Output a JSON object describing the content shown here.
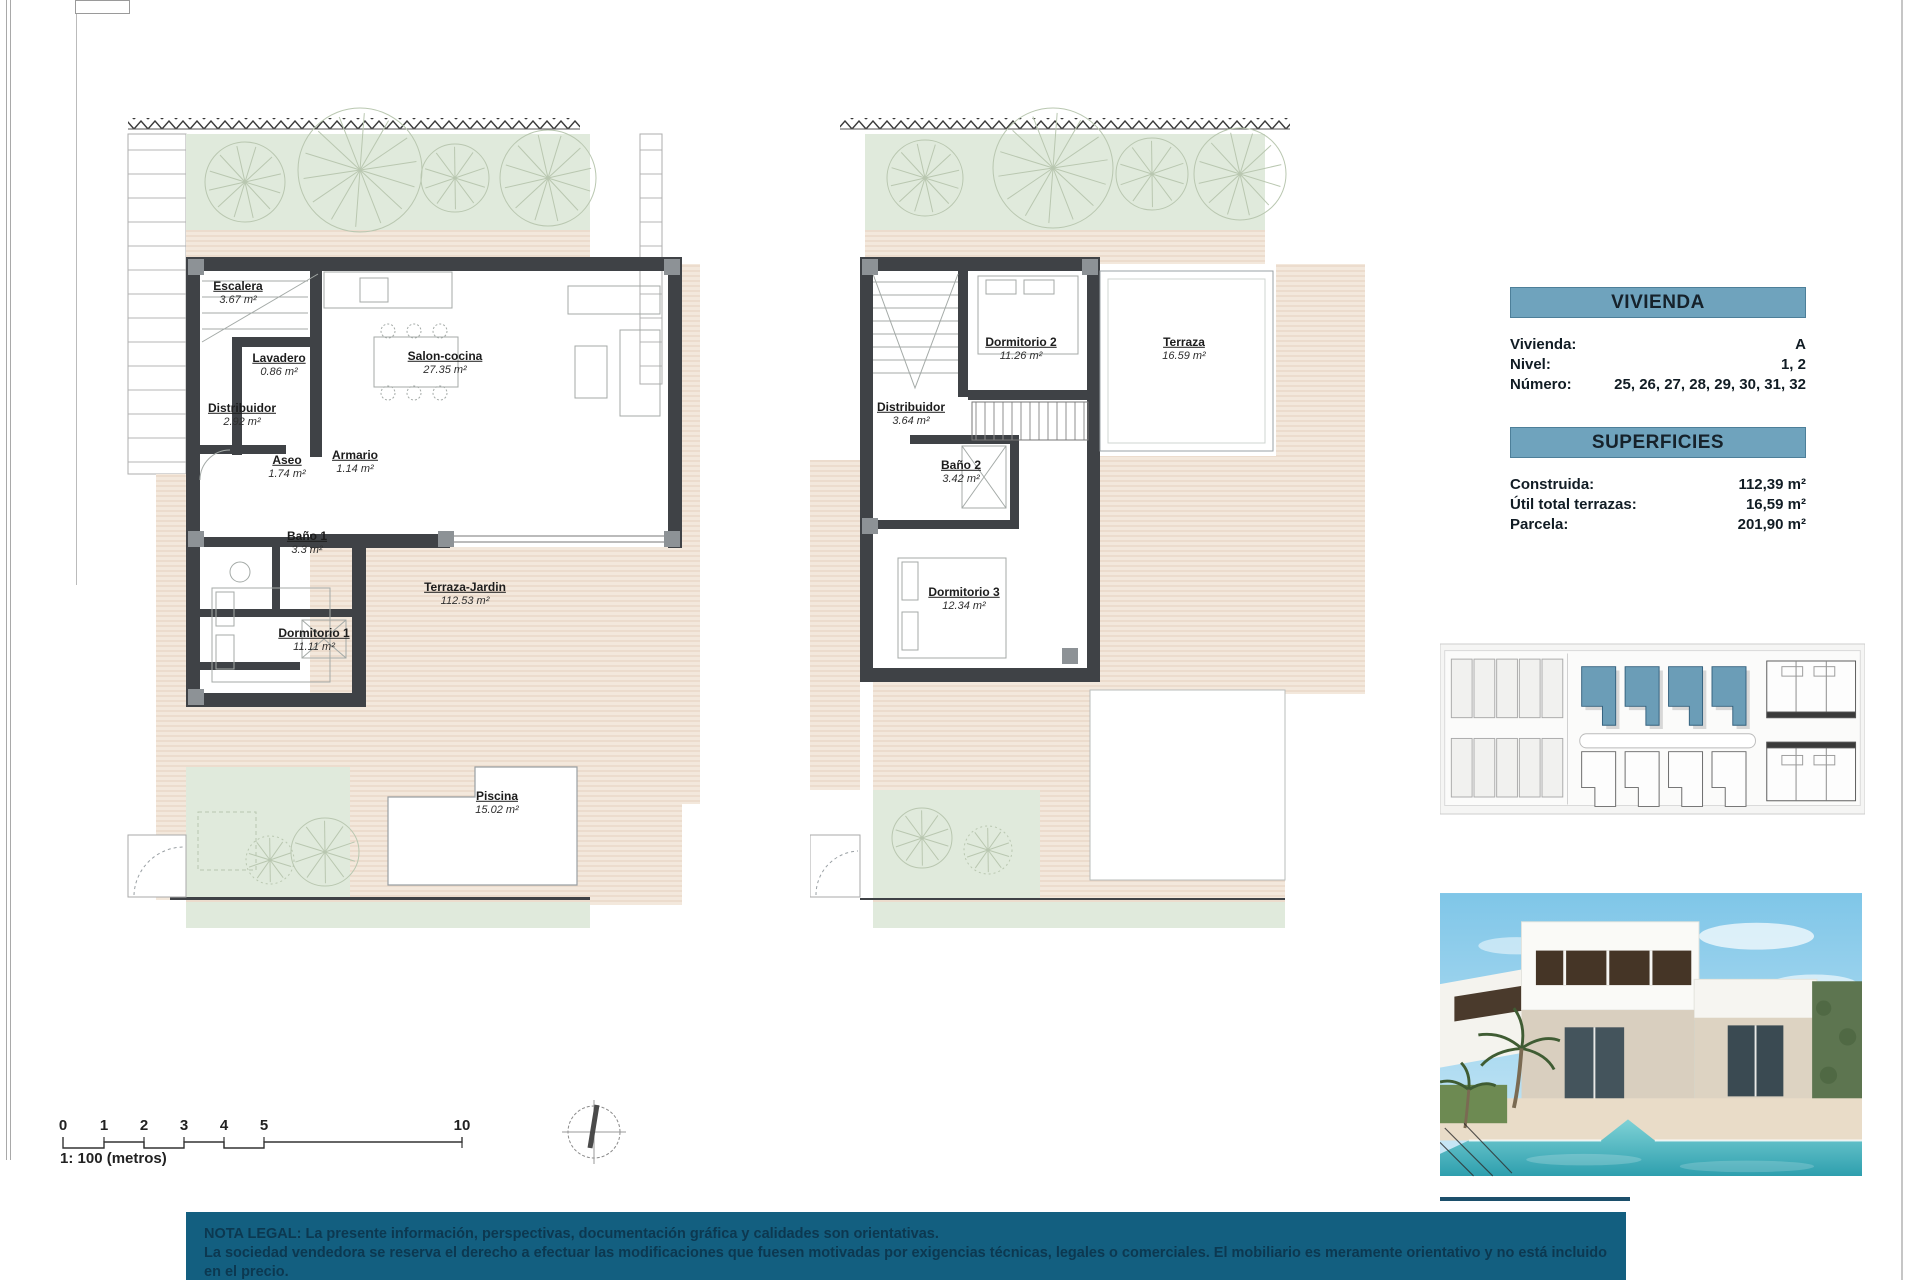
{
  "ground_floor": {
    "rooms": [
      {
        "name": "Escalera",
        "area": "3.67 m²",
        "x": 118,
        "y": 203
      },
      {
        "name": "Lavadero",
        "area": "0.86 m²",
        "x": 159,
        "y": 275
      },
      {
        "name": "Salon-cocina",
        "area": "27.35 m²",
        "x": 325,
        "y": 273
      },
      {
        "name": "Distribuidor",
        "area": "2.92 m²",
        "x": 122,
        "y": 325
      },
      {
        "name": "Aseo",
        "area": "1.74 m²",
        "x": 167,
        "y": 377
      },
      {
        "name": "Armario",
        "area": "1.14 m²",
        "x": 235,
        "y": 372
      },
      {
        "name": "Baño 1",
        "area": "3.3 m²",
        "x": 187,
        "y": 453
      },
      {
        "name": "Dormitorio 1",
        "area": "11.11 m²",
        "x": 194,
        "y": 550
      },
      {
        "name": "Terraza-Jardin",
        "area": "112.53 m²",
        "x": 345,
        "y": 504
      },
      {
        "name": "Piscina",
        "area": "15.02 m²",
        "x": 377,
        "y": 713
      }
    ]
  },
  "upper_floor": {
    "rooms": [
      {
        "name": "Dormitorio 2",
        "area": "11.26 m²",
        "x": 211,
        "y": 259
      },
      {
        "name": "Terraza",
        "area": "16.59 m²",
        "x": 374,
        "y": 259
      },
      {
        "name": "Distribuidor",
        "area": "3.64 m²",
        "x": 101,
        "y": 324
      },
      {
        "name": "Baño 2",
        "area": "3.42 m²",
        "x": 151,
        "y": 382
      },
      {
        "name": "Dormitorio 3",
        "area": "12.34 m²",
        "x": 154,
        "y": 509
      }
    ]
  },
  "vivienda_panel": {
    "title": "VIVIENDA",
    "rows": [
      {
        "label": "Vivienda:",
        "value": "A"
      },
      {
        "label": "Nivel:",
        "value": "1, 2"
      },
      {
        "label": "Número:",
        "value": "25, 26, 27, 28,  29, 30, 31, 32"
      }
    ]
  },
  "superficies_panel": {
    "title": "SUPERFICIES",
    "rows": [
      {
        "label": "Construida:",
        "value": "112,39 m²"
      },
      {
        "label": "Útil total terrazas:",
        "value": "16,59 m²"
      },
      {
        "label": "Parcela:",
        "value": "201,90 m²"
      }
    ]
  },
  "scale_bar": {
    "label": "1: 100 (metros)",
    "ticks": [
      {
        "t": "0",
        "x": 63
      },
      {
        "t": "1",
        "x": 104
      },
      {
        "t": "2",
        "x": 144
      },
      {
        "t": "3",
        "x": 184
      },
      {
        "t": "4",
        "x": 224
      },
      {
        "t": "5",
        "x": 264
      },
      {
        "t": "10",
        "x": 462
      }
    ]
  },
  "legal_note": {
    "line1": "NOTA LEGAL: La presente información, perspectivas, documentación gráfica y calidades son orientativas.",
    "line2": "La sociedad vendedora se reserva el derecho a efectuar las modificaciones que fuesen motivadas por exigencias técnicas, legales o comerciales. El mobiliario es meramente orientativo y no está incluido en el precio."
  },
  "colors": {
    "accent_header": "#6fa3bd",
    "legal_bar": "#135f80",
    "legal_text": "#0c3850",
    "highlight_unit": "#6b9db7",
    "wall": "#3f4246",
    "garden_green": "#e0eadc",
    "terrace_beige": "#f3e8dc"
  }
}
